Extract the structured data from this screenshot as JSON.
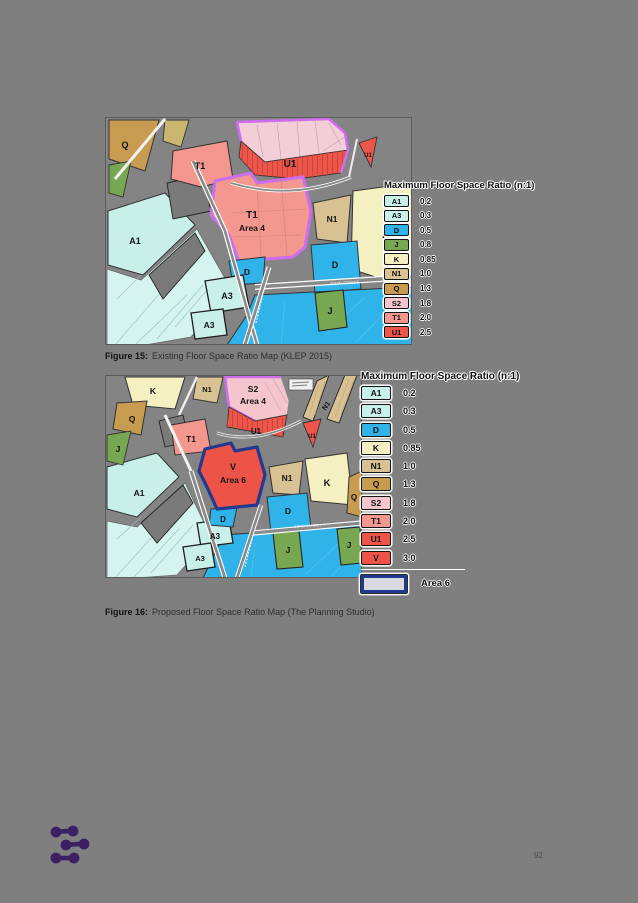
{
  "page": {
    "number": "92"
  },
  "colors": {
    "page_bg": "#7f7f7f",
    "map_bg": "#848484",
    "block": "#7a7a7a",
    "A1": "#c9efe9",
    "A3": "#c9efe9",
    "D": "#2fb3e9",
    "J": "#77a851",
    "K": "#f4f0c2",
    "N1": "#d8c294",
    "Q": "#c89c50",
    "S2": "#f4c5cc",
    "T1": "#f4978e",
    "U1": "#ef564b",
    "V": "#ee5347",
    "pale_pink": "#f3ced7",
    "pale_cyan": "#d6f4ee",
    "khaki": "#cbb670",
    "area4_outline": "#cf6df0",
    "area6_outline": "#24388f",
    "area6_swatch_fill": "#d8dce2",
    "logo": "#3b2064"
  },
  "figure15": {
    "caption": {
      "prefix": "Figure 15:",
      "text": "Existing Floor Space Ratio Map (KLEP 2015)"
    },
    "legend": {
      "title": "Maximum Floor Space Ratio (n:1)",
      "entries": [
        {
          "code": "A1",
          "value": "0.2",
          "color": "#c9efe9"
        },
        {
          "code": "A3",
          "value": "0.3",
          "color": "#c9efe9"
        },
        {
          "code": "D",
          "value": "0.5",
          "color": "#2fb3e9"
        },
        {
          "code": "J",
          "value": "0.8",
          "color": "#77a851"
        },
        {
          "code": "K",
          "value": "0.85",
          "color": "#f4f0c2"
        },
        {
          "code": "N1",
          "value": "1.0",
          "color": "#d8c294"
        },
        {
          "code": "Q",
          "value": "1.3",
          "color": "#c89c50"
        },
        {
          "code": "S2",
          "value": "1.8",
          "color": "#f4c5cc"
        },
        {
          "code": "T1",
          "value": "2.0",
          "color": "#f4978e"
        },
        {
          "code": "U1",
          "value": "2.5",
          "color": "#ef564b"
        }
      ]
    },
    "zone_labels": [
      {
        "t": "Q",
        "x": 20,
        "y": 31,
        "s": 9
      },
      {
        "t": "T1",
        "x": 95,
        "y": 52,
        "s": 9
      },
      {
        "t": "U1",
        "x": 185,
        "y": 50,
        "s": 10
      },
      {
        "t": "U1",
        "x": 263,
        "y": 40,
        "s": 6
      },
      {
        "t": "T1",
        "x": 147,
        "y": 101,
        "s": 10
      },
      {
        "t": "Area 4",
        "x": 147,
        "y": 114,
        "s": 8.5
      },
      {
        "t": "N1",
        "x": 227,
        "y": 105,
        "s": 8.5
      },
      {
        "t": "K",
        "x": 281,
        "y": 121,
        "s": 11
      },
      {
        "t": "A1",
        "x": 30,
        "y": 127,
        "s": 9
      },
      {
        "t": "D",
        "x": 142,
        "y": 158,
        "s": 8.5
      },
      {
        "t": "D",
        "x": 230,
        "y": 151,
        "s": 9
      },
      {
        "t": "A3",
        "x": 122,
        "y": 182,
        "s": 9
      },
      {
        "t": "A3",
        "x": 104,
        "y": 211,
        "s": 8.5
      },
      {
        "t": "J",
        "x": 225,
        "y": 197,
        "s": 9
      }
    ],
    "street_labels": [
      {
        "t": "BOYD STREET",
        "x": 240,
        "y": 167,
        "s": 3.6,
        "r": -3
      }
    ]
  },
  "figure16": {
    "caption": {
      "prefix": "Figure 16:",
      "text": "Proposed Floor Space Ratio Map (The Planning Studio)"
    },
    "legend": {
      "title": "Maximum Floor Space Ratio (n:1)",
      "entries": [
        {
          "code": "A1",
          "value": "0.2",
          "color": "#c9efe9"
        },
        {
          "code": "A3",
          "value": "0.3",
          "color": "#c9efe9"
        },
        {
          "code": "D",
          "value": "0.5",
          "color": "#2fb3e9"
        },
        {
          "code": "K",
          "value": "0.85",
          "color": "#f4f0c2"
        },
        {
          "code": "N1",
          "value": "1.0",
          "color": "#d8c294"
        },
        {
          "code": "Q",
          "value": "1.3",
          "color": "#c89c50"
        },
        {
          "code": "S2",
          "value": "1.8",
          "color": "#f4c5cc"
        },
        {
          "code": "T1",
          "value": "2.0",
          "color": "#f4978e"
        },
        {
          "code": "U1",
          "value": "2.5",
          "color": "#ef564b"
        },
        {
          "code": "V",
          "value": "3.0",
          "color": "#ee5347"
        }
      ],
      "area_entry": {
        "label": "Area 6"
      }
    },
    "zone_labels": [
      {
        "t": "K",
        "x": 48,
        "y": 19,
        "s": 8.5
      },
      {
        "t": "N1",
        "x": 102,
        "y": 17,
        "s": 7.5
      },
      {
        "t": "S2",
        "x": 148,
        "y": 17,
        "s": 8.5
      },
      {
        "t": "Area 4",
        "x": 148,
        "y": 29,
        "s": 8.5
      },
      {
        "t": "Q",
        "x": 27,
        "y": 47,
        "s": 8.5
      },
      {
        "t": "J",
        "x": 13,
        "y": 77,
        "s": 8.5
      },
      {
        "t": "T1",
        "x": 86,
        "y": 67,
        "s": 8.5
      },
      {
        "t": "U1",
        "x": 151,
        "y": 59,
        "s": 8
      },
      {
        "t": "U1",
        "x": 207,
        "y": 63,
        "s": 6
      },
      {
        "t": "N1",
        "x": 223,
        "y": 32,
        "s": 7,
        "r": -55
      },
      {
        "t": "V",
        "x": 128,
        "y": 95,
        "s": 9
      },
      {
        "t": "Area 6",
        "x": 128,
        "y": 108,
        "s": 8.5
      },
      {
        "t": "D",
        "x": 118,
        "y": 147,
        "s": 8
      },
      {
        "t": "N1",
        "x": 182,
        "y": 106,
        "s": 8.5
      },
      {
        "t": "K",
        "x": 222,
        "y": 111,
        "s": 9.5
      },
      {
        "t": "Q",
        "x": 249,
        "y": 125,
        "s": 8
      },
      {
        "t": "D",
        "x": 183,
        "y": 139,
        "s": 8.5
      },
      {
        "t": "A1",
        "x": 34,
        "y": 121,
        "s": 8.5
      },
      {
        "t": "A3",
        "x": 110,
        "y": 164,
        "s": 8
      },
      {
        "t": "A3",
        "x": 95,
        "y": 186,
        "s": 7.5
      },
      {
        "t": "J",
        "x": 183,
        "y": 178,
        "s": 8.5
      },
      {
        "t": "J",
        "x": 244,
        "y": 173,
        "s": 8.5
      }
    ],
    "street_labels": [
      {
        "t": "BOYD STREET",
        "x": 203,
        "y": 152,
        "s": 3.4,
        "r": -3
      }
    ]
  }
}
